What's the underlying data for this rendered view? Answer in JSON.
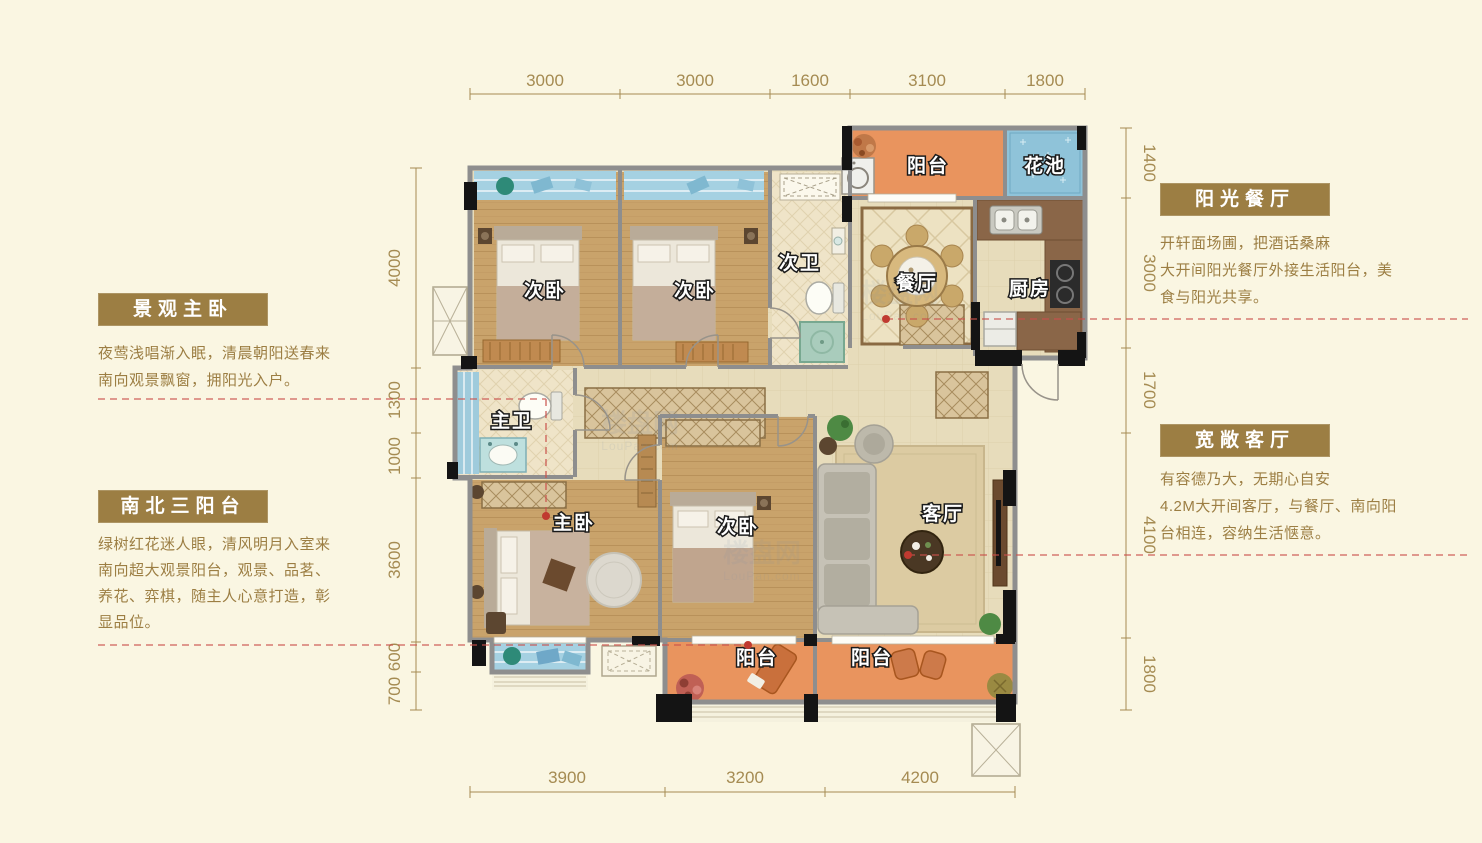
{
  "page": {
    "background": "#FAF6E2"
  },
  "colors": {
    "accent_gold": "#9C7E43",
    "dimension_gold": "#A58B52",
    "annotation_red": "#C9504B",
    "wall_gray": "#8E8E8E",
    "column_black": "#141414",
    "balcony_orange": "#E9945E",
    "window_blue": "#A5D1E2",
    "flower_pond_blue": "#8FC3D9",
    "wood_floor": "#C9A36B",
    "tile_cream": "#E7DCBB"
  },
  "dimensions": {
    "top": [
      "3000",
      "3000",
      "1600",
      "3100",
      "1800"
    ],
    "bottom": [
      "3900",
      "3200",
      "4200"
    ],
    "left": [
      "4000",
      "1300",
      "1000",
      "3600",
      "600",
      "700"
    ],
    "right": [
      "1400",
      "3000",
      "1700",
      "4100",
      "1800"
    ]
  },
  "rooms": {
    "balcony_top": "阳台",
    "flower_pond": "花池",
    "bedroom_a": "次卧",
    "bedroom_b": "次卧",
    "bath_second": "次卫",
    "dining": "餐厅",
    "kitchen": "厨房",
    "bath_master": "主卫",
    "master_bedroom": "主卧",
    "bedroom_c": "次卧",
    "living": "客厅",
    "balcony_south_left": "阳台",
    "balcony_south_right": "阳台"
  },
  "callouts": {
    "master_bedroom": {
      "title": "景观主卧",
      "lines": [
        "夜莺浅唱渐入眠，清晨朝阳送春来",
        "南向观景飘窗，拥阳光入户。"
      ]
    },
    "balconies": {
      "title": "南北三阳台",
      "lines": [
        "绿树红花迷人眼，清风明月入室来",
        "南向超大观景阳台，观景、品茗、",
        "养花、弈棋，随主人心意打造，彰",
        "显品位。"
      ]
    },
    "dining": {
      "title": "阳光餐厅",
      "lines": [
        "开轩面场圃，把酒话桑麻",
        "大开间阳光餐厅外接生活阳台，美",
        "食与阳光共享。"
      ]
    },
    "living": {
      "title": "宽敞客厅",
      "lines": [
        "有容德乃大，无期心自安",
        "4.2M大开间客厅，与餐厅、南向阳",
        "台相连，容纳生活惬意。"
      ]
    }
  },
  "watermark": {
    "name": "楼盘网",
    "domain": "LouPan.com"
  }
}
